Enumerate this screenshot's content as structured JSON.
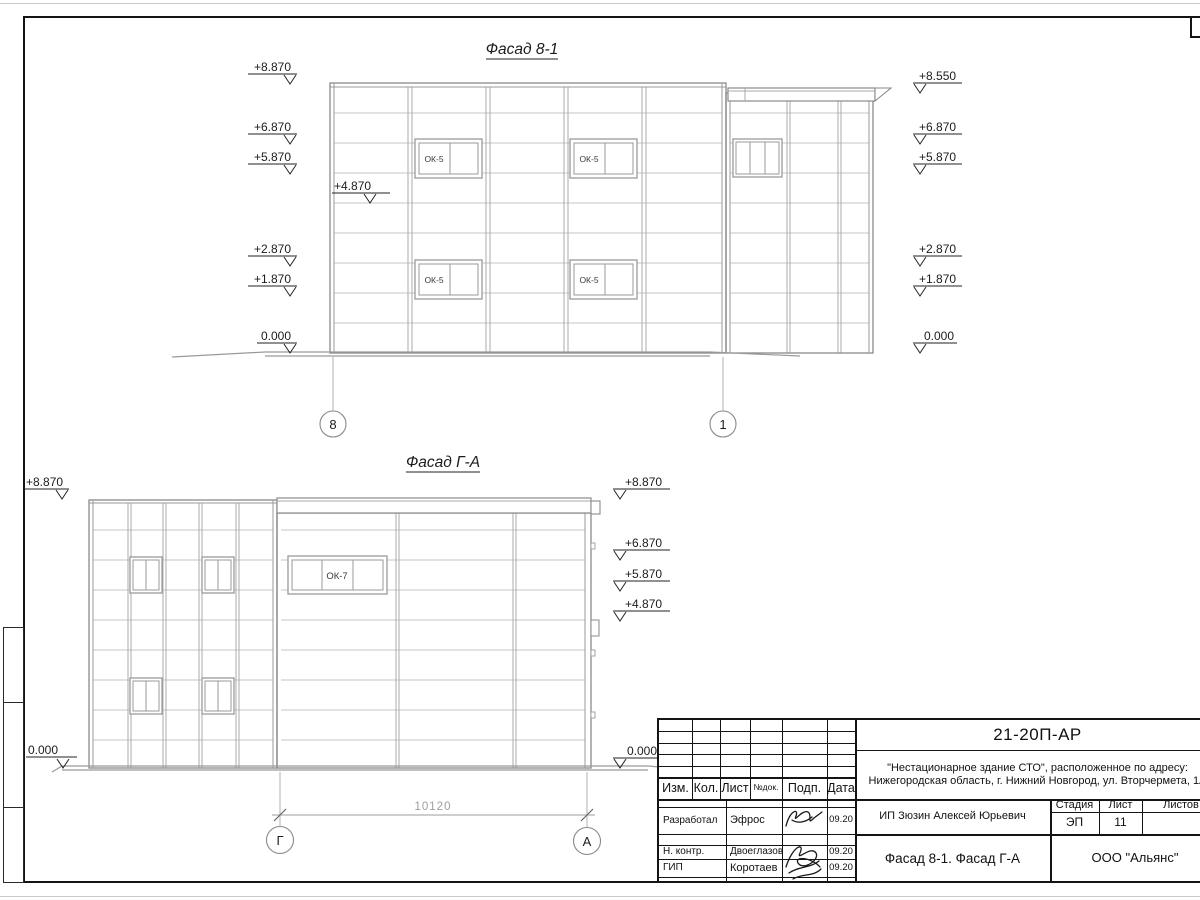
{
  "drawing": {
    "facade1": {
      "title": "Фасад 8-1",
      "window_label": "ОК-5",
      "elev_l1": "+8.870",
      "elev_l2": "+6.870",
      "elev_l3": "+5.870",
      "elev_l4": "+4.870",
      "elev_l5": "+2.870",
      "elev_l6": "+1.870",
      "elev_l7": "0.000",
      "elev_r1": "+8.550",
      "elev_r2": "+6.870",
      "elev_r3": "+5.870",
      "elev_r4": "+2.870",
      "elev_r5": "+1.870",
      "elev_r6": "0.000",
      "axis_left": "8",
      "axis_right": "1"
    },
    "facade2": {
      "title": "Фасад Г-А",
      "window_label": "ОК-7",
      "elev_l1": "+8.870",
      "elev_l2": "0.000",
      "elev_r1": "+8.870",
      "elev_r2": "+6.870",
      "elev_r3": "+5.870",
      "elev_r4": "+4.870",
      "elev_r5": "0.000",
      "dimension": "10120",
      "axis_left": "Г",
      "axis_right": "А"
    }
  },
  "title_block": {
    "doc_number": "21-20П-АР",
    "project_line1": "\"Нестационарное здание СТО\", расположенное по адресу:",
    "project_line2": "Нижегородская область, г. Нижний Новгород, ул. Вторчермета, 1А",
    "col_izm": "Изм.",
    "col_kol": "Кол.",
    "col_list": "Лист",
    "col_ndok": "№док.",
    "col_podp": "Подп.",
    "col_data": "Дата",
    "row1_role": "Разработал",
    "row1_name": "Эфрос",
    "row1_date": "09.20",
    "row2_role": "Н. контр.",
    "row2_name": "Двоеглазов",
    "row2_date": "09.20",
    "row3_role": "ГИП",
    "row3_name": "Коротаев",
    "row3_date": "09.20",
    "client": "ИП Зюзин Алексей Юрьевич",
    "stage_label": "Стадия",
    "sheet_label": "Лист",
    "sheets_label": "Листов",
    "stage_value": "ЭП",
    "sheet_value": "11",
    "sheet_title": "Фасад 8-1. Фасад Г-А",
    "organization": "ООО \"Альянс\""
  }
}
